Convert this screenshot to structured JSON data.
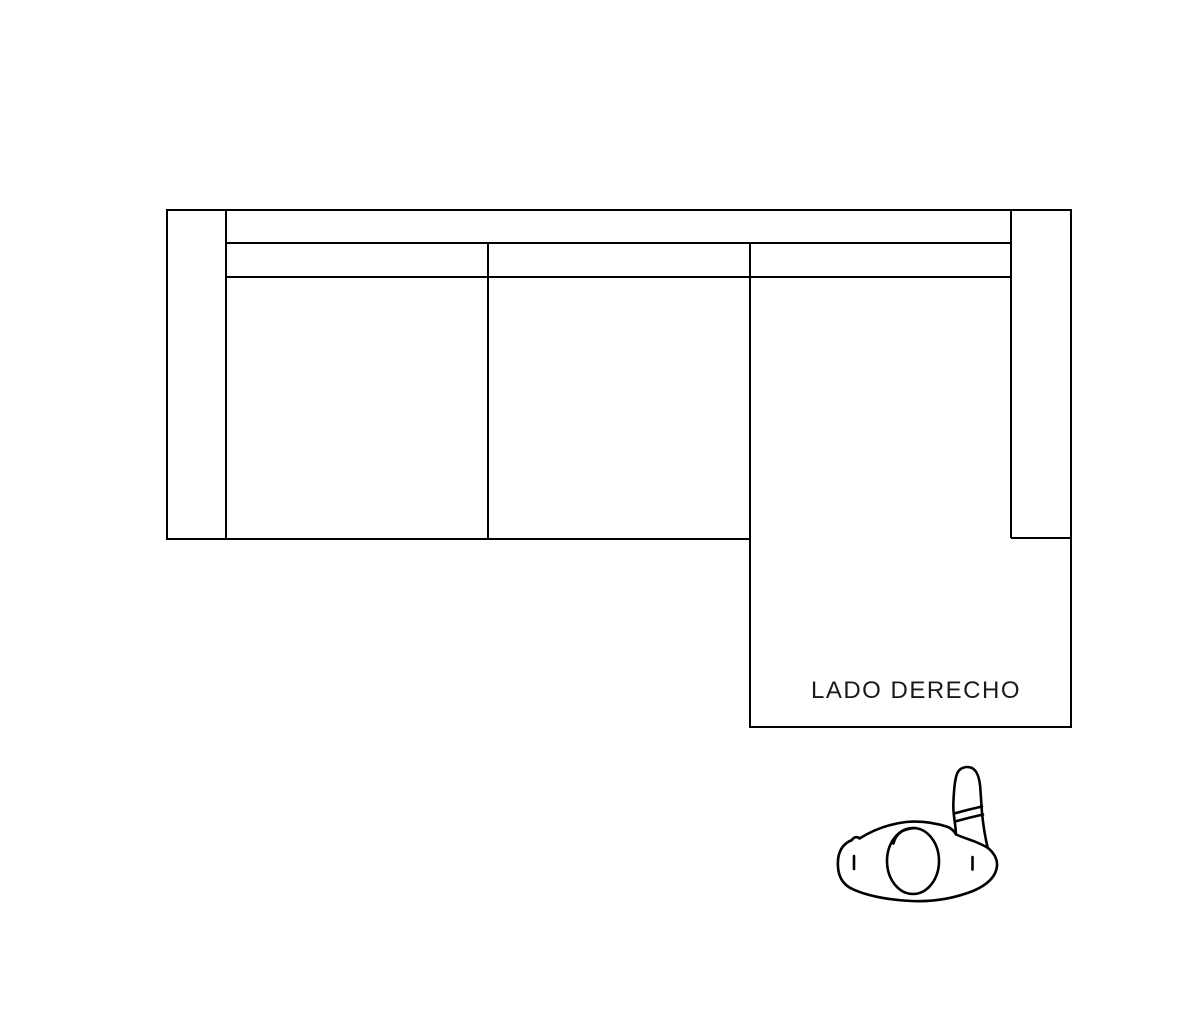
{
  "diagram": {
    "chaise_label": "LADO DERECHO",
    "colors": {
      "background": "#ffffff",
      "line": "#000000",
      "label_text": "#1a1a1a",
      "shape_fill": "#ffffff"
    },
    "parts": [
      "left-armrest",
      "backrest",
      "seat-back-strip",
      "seat-cushion-1",
      "seat-cushion-2",
      "chaise-section",
      "right-armrest"
    ],
    "icons": {
      "person_figure": "person-top-view-icon"
    }
  }
}
